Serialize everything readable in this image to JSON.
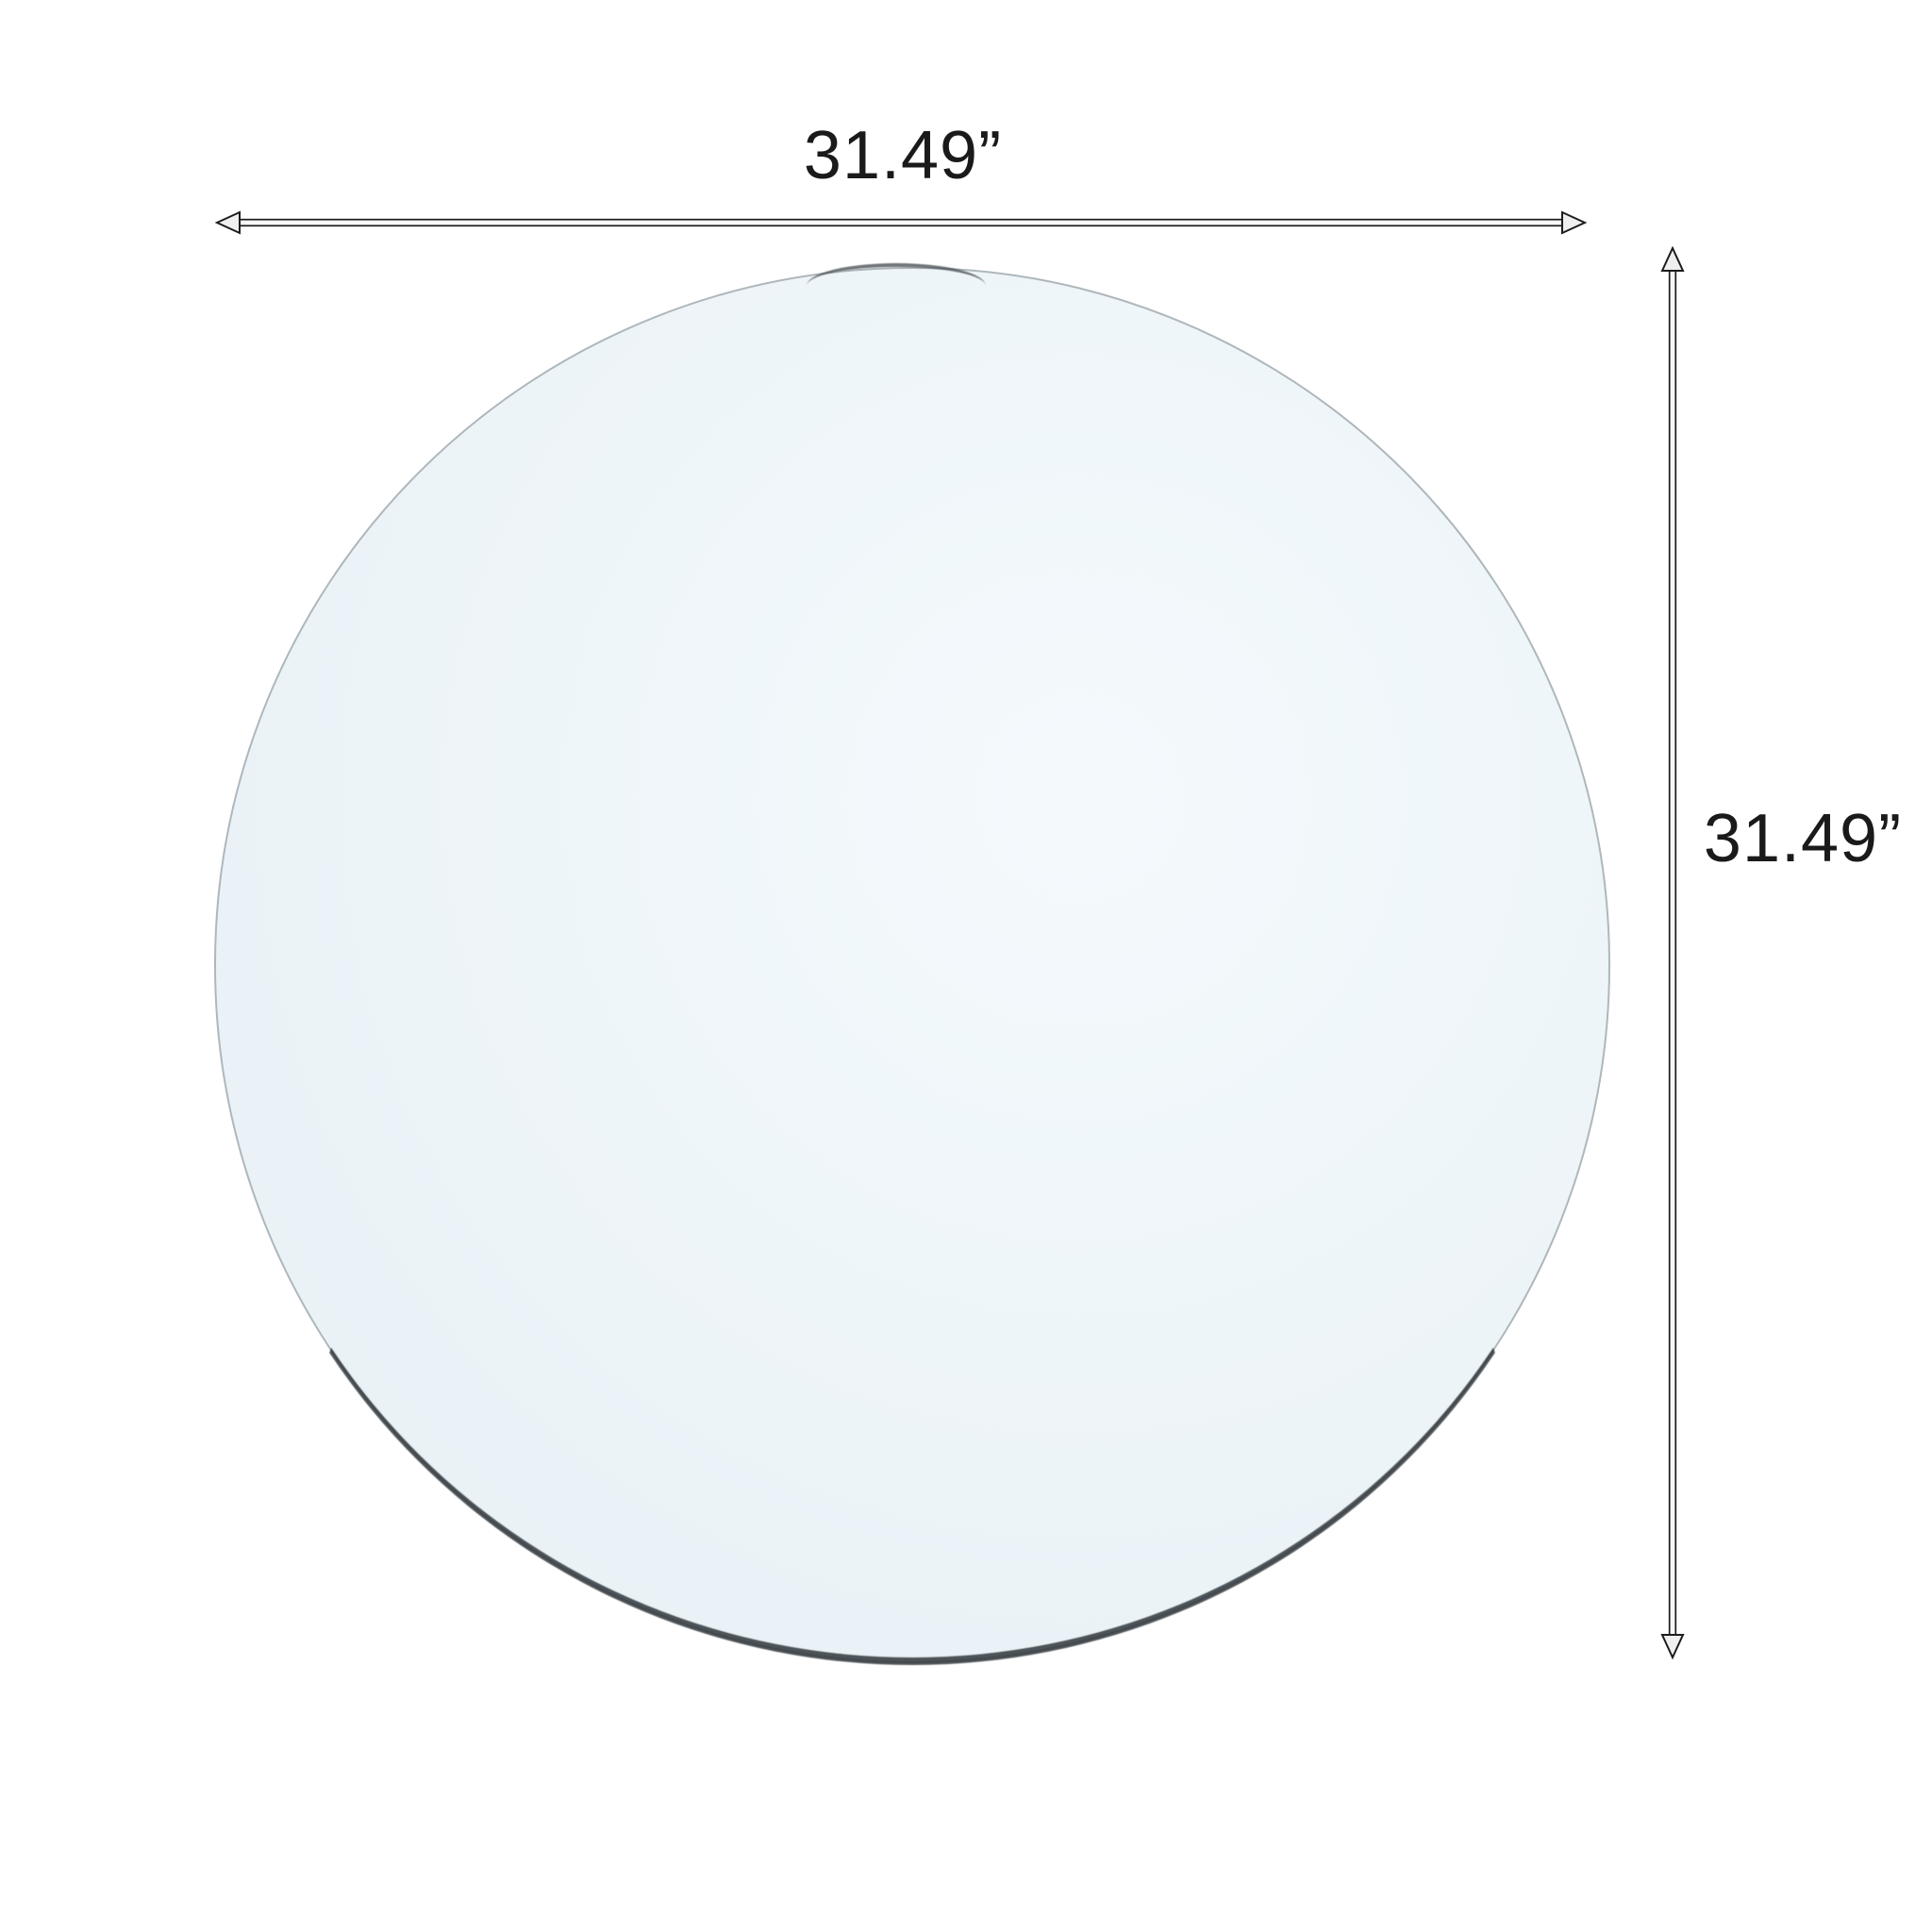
{
  "diagram": {
    "kind": "product-dimension-diagram",
    "width_label": "31.49”",
    "height_label": "31.49”",
    "colors": {
      "background": "#ffffff",
      "glass_tint": "#edf4f8",
      "glass_edge": "#aeb7bc",
      "glass_edge_dark": "#30373c",
      "dimension_line": "#1c1c1c",
      "label_text": "#1a1a1a"
    }
  }
}
